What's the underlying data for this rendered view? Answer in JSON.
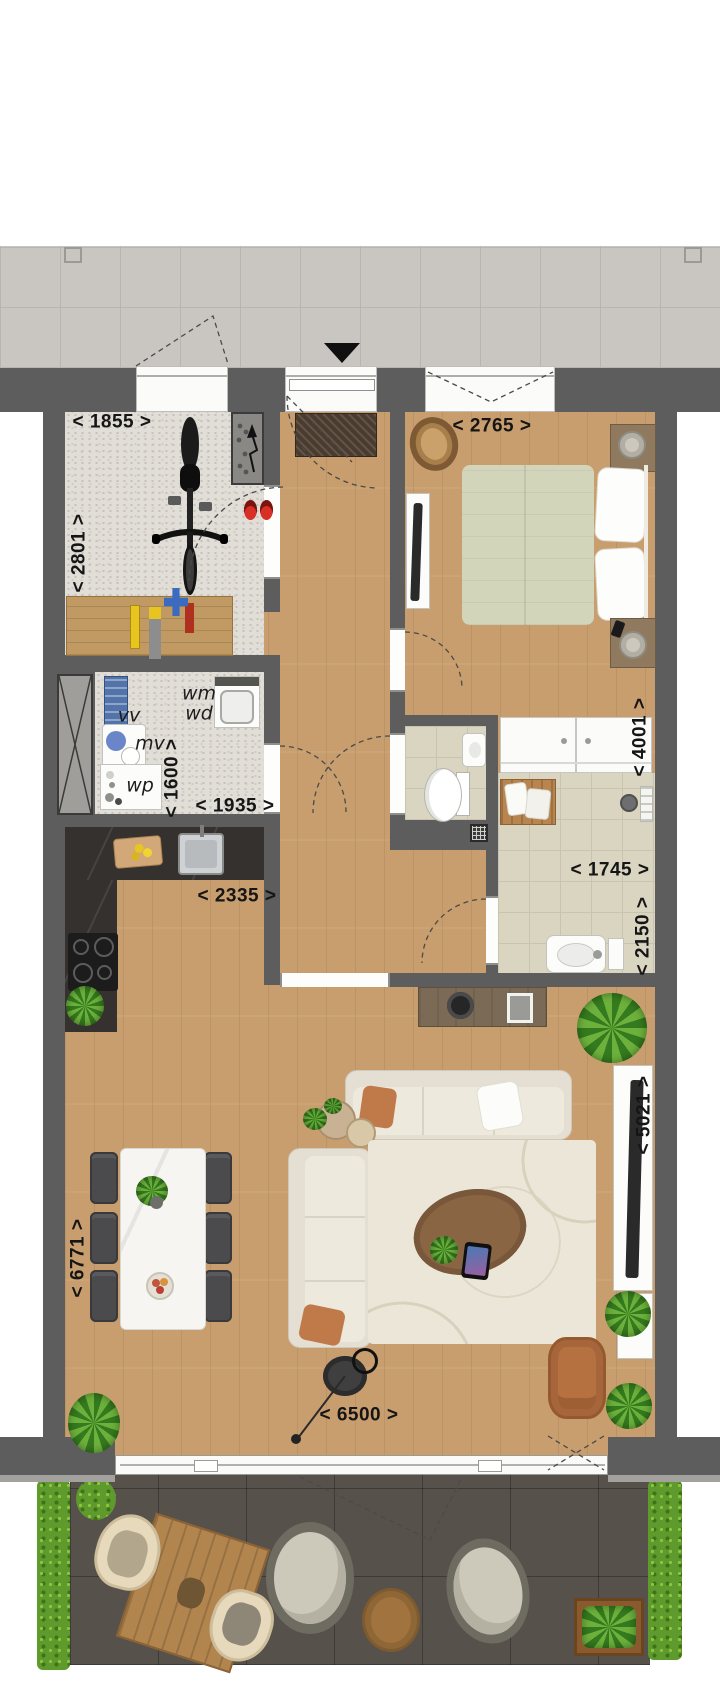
{
  "plan": {
    "type": "apartment-floor-plan-top-view",
    "dims": {
      "storage_width": "< 1855 >",
      "storage_depth": "< 2801 >",
      "bedroom_width": "< 2765 >",
      "bedroom_depth": "< 4001 >",
      "utility_depth": "< 1600 >",
      "utility_width": "< 1935 >",
      "kitchen_width": "< 2335 >",
      "bathroom_width": "< 1745 >",
      "bathroom_depth": "< 2150 >",
      "living_depth_right": "< 5021 >",
      "living_depth_left": "< 6771 >",
      "living_width": "< 6500 >"
    },
    "units": {
      "vv": "vv",
      "mv": "mv",
      "wp": "wp",
      "wm": "wm",
      "wd": "wd"
    },
    "icons": {
      "entrance_marker": "down-triangle",
      "electric_meter": "lightning-arrow",
      "shaft": "crossed-box",
      "floor_drain": "grid-square"
    },
    "colors": {
      "wall": "#5d5d5d",
      "wood_floor": "#c89e6e",
      "corridor_tile": "#c9c6c1",
      "terrace_tile": "#57514b",
      "bathroom_tile": "#d9d5c1",
      "utility_floor": "#e1ddd7",
      "kitchen_counter": "#34312e",
      "hedge_green": "#5f9a2d",
      "sofa_cream": "#e4dfd2",
      "armchair_rust": "#b5713f",
      "bed_duvet": "#d3d5ba",
      "rug": "#ece6d9",
      "accent_red": "#d93025"
    }
  }
}
